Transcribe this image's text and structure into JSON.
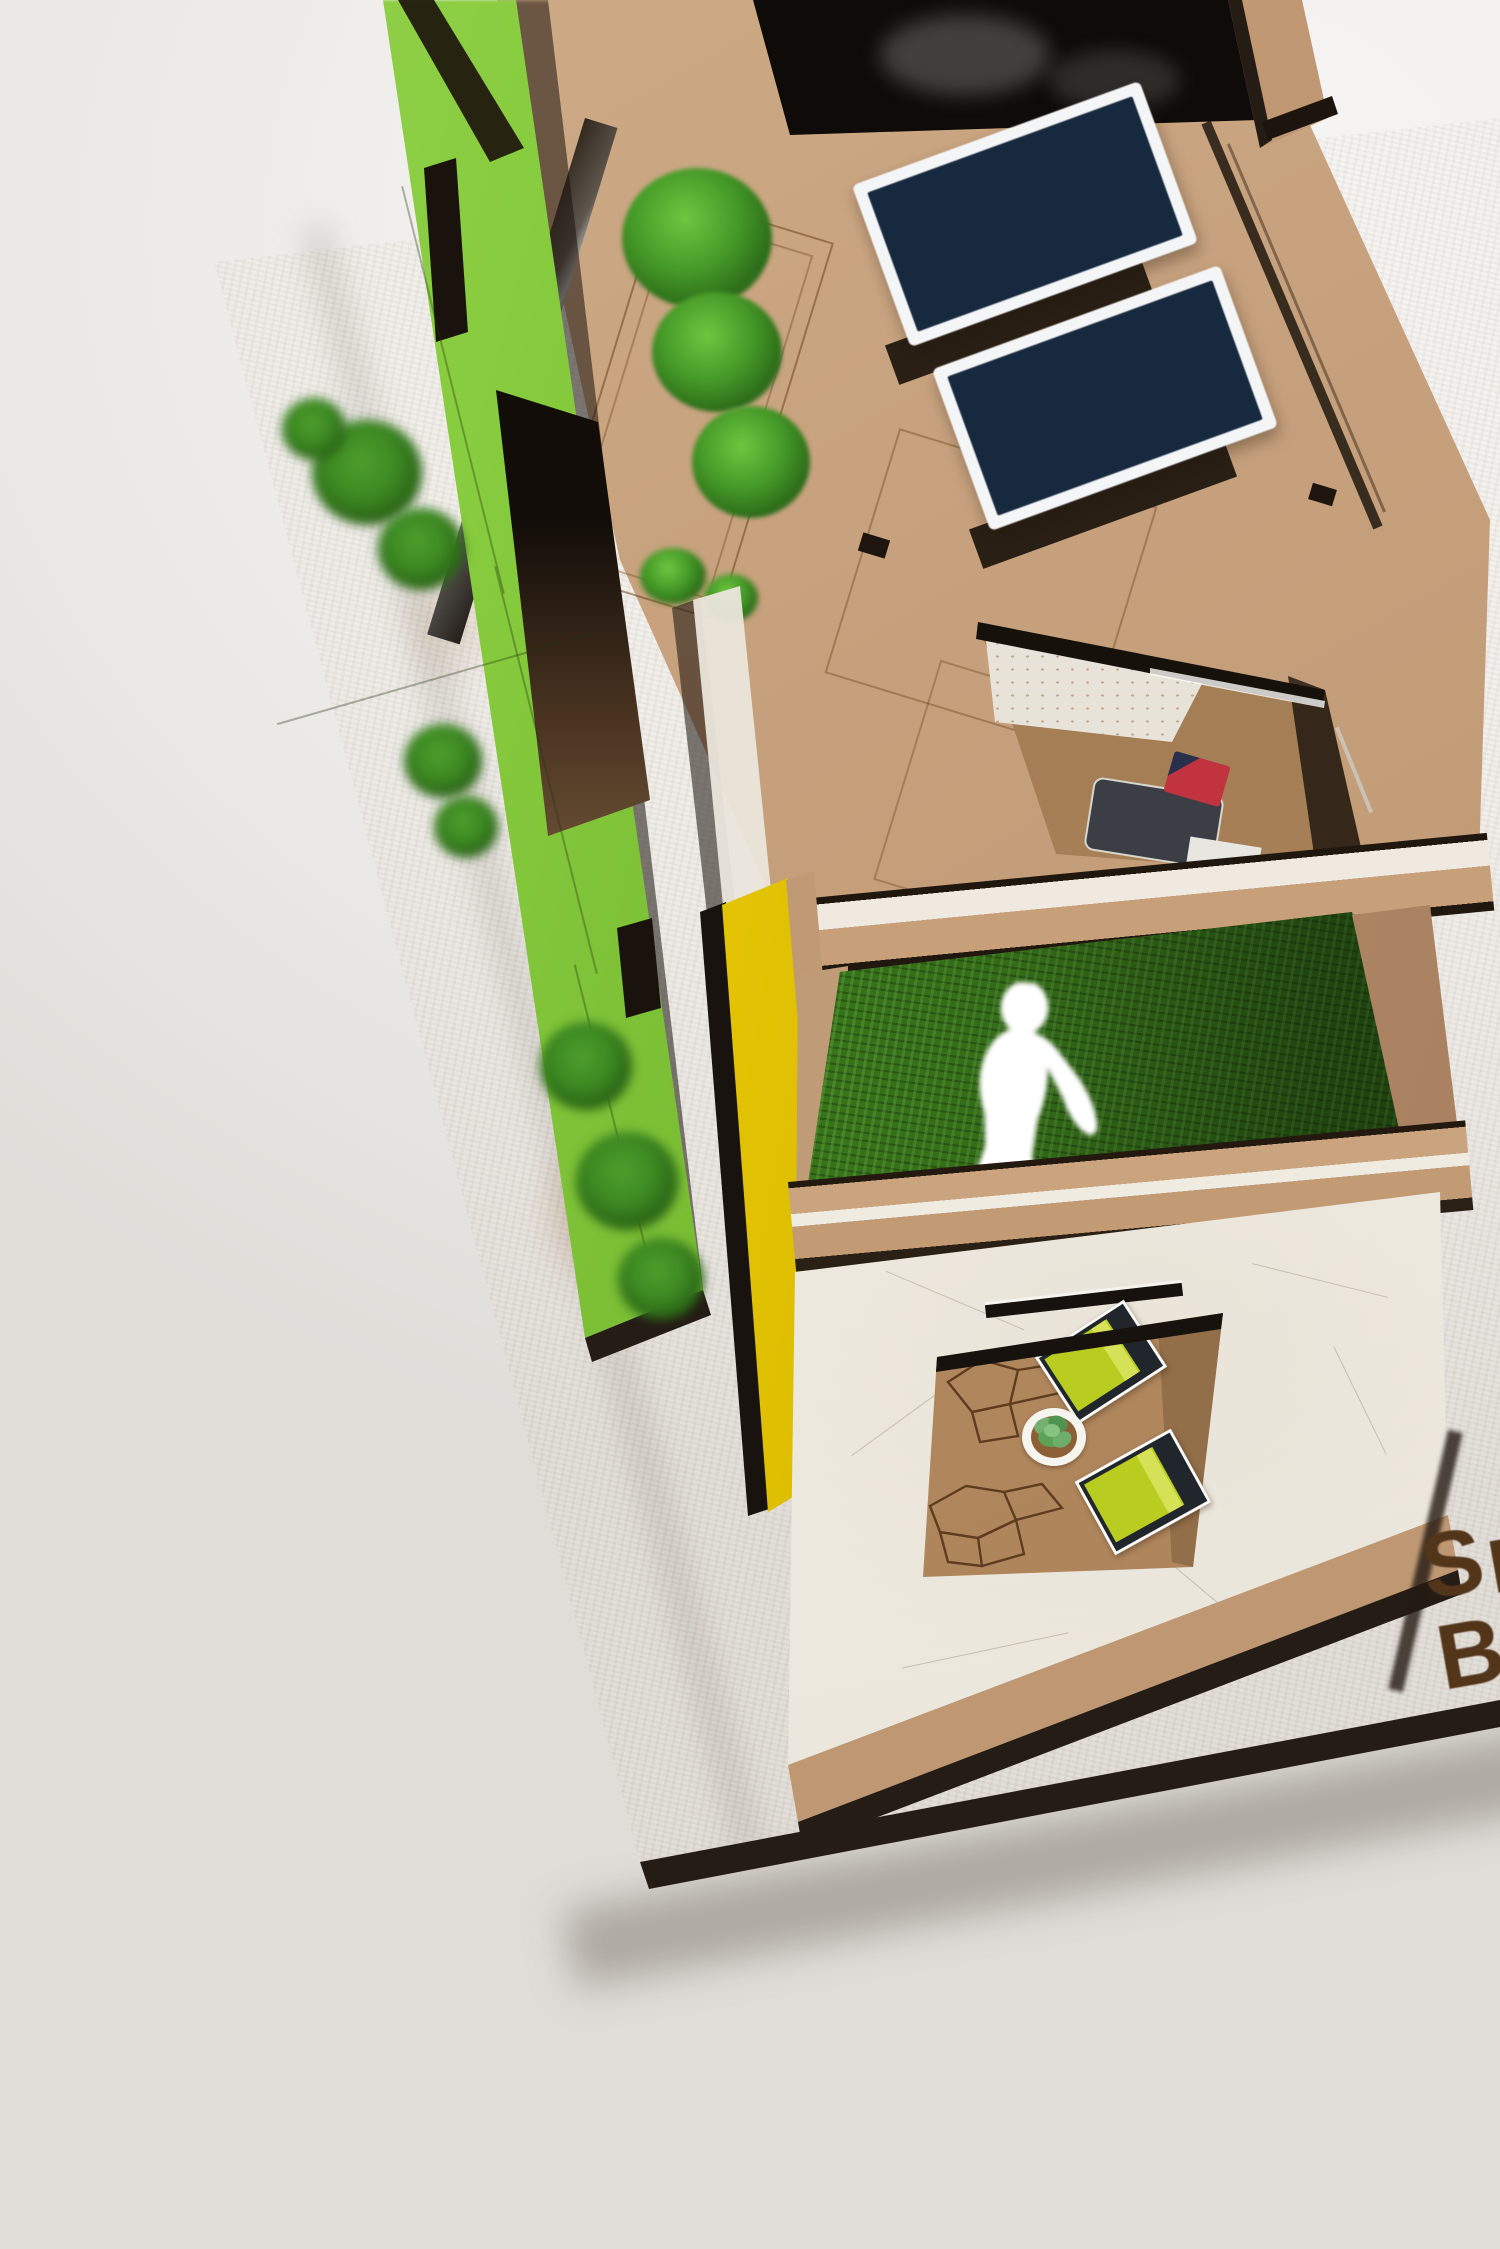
{
  "branding": {
    "engraved_line1": "S",
    "engraved_line2": "B"
  },
  "scene": {
    "subject": "laser-cut wooden architecture model photographed on white backdrop",
    "solar_panel_count": 2,
    "roof_shrub_count": 3,
    "courtyard_bed_count": 2,
    "figure": "white human silhouette standing on grass terrace"
  },
  "palette": {
    "backdrop": "#f0efec",
    "backdrop_bright": "#f6f5f4",
    "backdrop_dim": "#e0ddd9",
    "mdf": "#c6a17c",
    "mdf_dark": "#b08a61",
    "burnt": "#241c15",
    "green_wall": "#88cc3f",
    "green_wall_light": "#9ad455",
    "green_wall_dark": "#72b52e",
    "yellow": "#f2d70d",
    "yellow_dark": "#d9ba00",
    "grass_dark": "#2e5d18",
    "grass_bright": "#3d7c1f",
    "shrub": "#459a28",
    "shrub_light": "#6fc63f",
    "shrub_dark": "#2c6b19",
    "panel_frame": "#f3f5f6",
    "panel_cell": "#17293f",
    "white_wall": "#f1ede5",
    "bed_green": "#b8cd1f",
    "bed_stripe": "#d5e257",
    "bed_frame": "#20262b",
    "pillow_red": "#c23340",
    "mat_gray": "#3b3e44",
    "letter": "#53351a"
  }
}
